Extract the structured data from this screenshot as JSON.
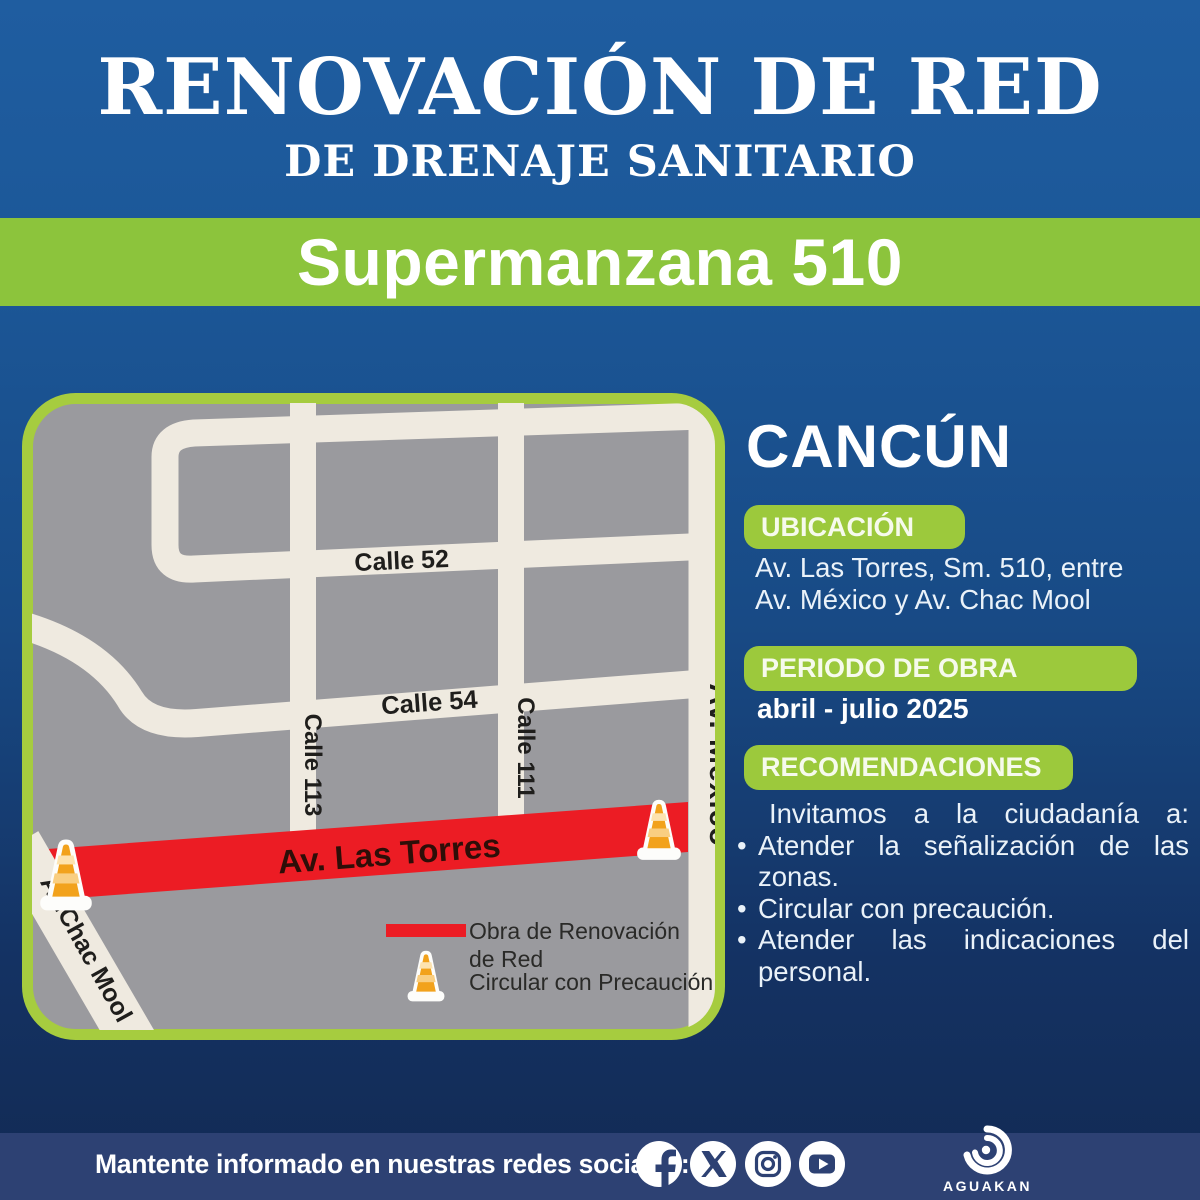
{
  "header": {
    "title": "RENOVACIÓN DE RED",
    "subtitle": "DE DRENAJE SANITARIO"
  },
  "banner": {
    "text": "Supermanzana 510"
  },
  "map": {
    "labels": {
      "calle_52": "Calle 52",
      "calle_54": "Calle 54",
      "calle_113": "Calle 113",
      "calle_111": "Calle 111",
      "av_mexico": "Av. México",
      "av_las_torres": "Av. Las Torres",
      "av_chac_mool": "Av.Chac Mool"
    },
    "legend": {
      "work_line1": "Obra de Renovación",
      "work_line2": "de Red",
      "caution": "Circular con Precaución"
    }
  },
  "info": {
    "city": "CANCÚN",
    "ubicacion": {
      "heading": "UBICACIÓN",
      "line1": "Av. Las Torres, Sm. 510, entre",
      "line2": "Av. México y Av. Chac Mool"
    },
    "periodo": {
      "heading": "PERIODO DE OBRA",
      "value": "abril - julio 2025"
    },
    "recomendaciones": {
      "heading": "RECOMENDACIONES",
      "intro": "Invitamos a la ciudadanía a:",
      "bullets": [
        "Atender la señalización de las zonas.",
        "Circular con precaución.",
        "Atender las indicaciones del personal."
      ]
    }
  },
  "footer": {
    "message": "Mantente informado en nuestras redes sociales:",
    "social": [
      "facebook",
      "x",
      "instagram",
      "youtube"
    ],
    "brand": "AGUAKAN"
  },
  "colors": {
    "header_blue_top": "#1F5DA0",
    "background_blue_bottom": "#122A53",
    "banner_green": "#8CC43C",
    "pill_green": "#9CC93C",
    "map_border_green": "#A6CC3F",
    "map_ground_gray": "#9A9A9E",
    "street_cream": "#EFEAE0",
    "work_red": "#EC1C24",
    "footer_navy": "#2D4173"
  }
}
